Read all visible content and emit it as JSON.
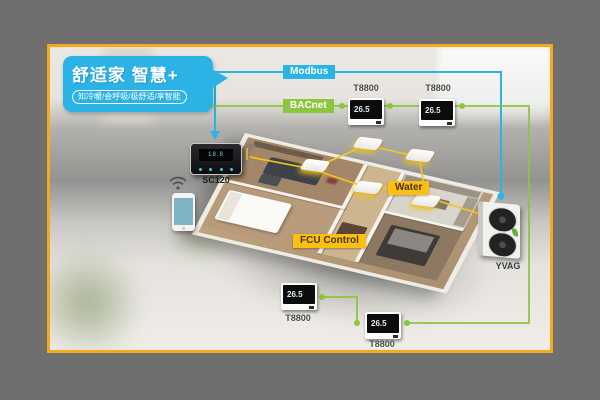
{
  "bubble": {
    "title": "舒适家 智慧+",
    "subtitle": "知冷暖/会呼吸/极舒适/享智能"
  },
  "labels": {
    "modbus": "Modbus",
    "bacnet": "BACnet",
    "water": "Water",
    "fcu_control": "FCU Control"
  },
  "devices": {
    "sc120": {
      "label": "SC120",
      "display": "18.8"
    },
    "t8800": {
      "label": "T8800",
      "display": "26.5"
    },
    "yvag": {
      "label": "YVAG"
    }
  },
  "colors": {
    "modbus_line": "#29b4e4",
    "bacnet_line": "#8cc63e",
    "water_line": "#f7c51e",
    "frame_border": "#f7a81b",
    "outer_background": "#6f6f6f",
    "bubble": "#2bb3e6"
  }
}
